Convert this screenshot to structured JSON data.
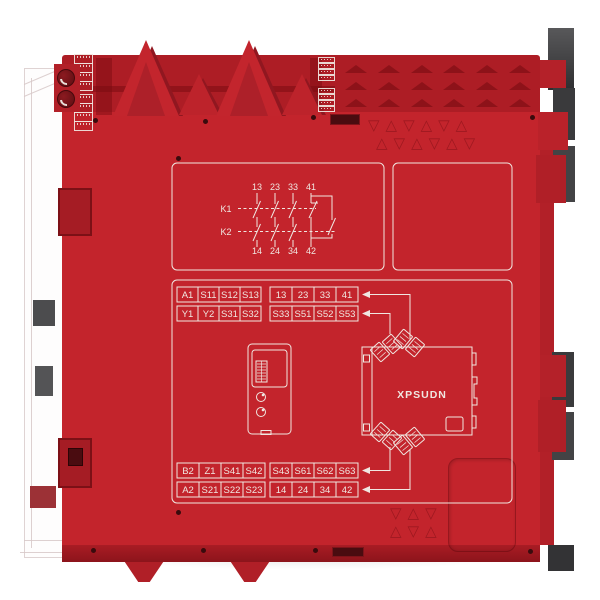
{
  "product": {
    "model_label": "XPSUDN"
  },
  "contact_diagram": {
    "top_terminals": [
      "13",
      "23",
      "33",
      "41"
    ],
    "relays": [
      "K1",
      "K2"
    ],
    "bottom_terminals": [
      "14",
      "24",
      "34",
      "42"
    ]
  },
  "terminal_tables": {
    "top_left": [
      [
        "A1",
        "S11",
        "S12",
        "S13"
      ],
      [
        "Y1",
        "Y2",
        "S31",
        "S32"
      ]
    ],
    "top_right": [
      [
        "13",
        "23",
        "33",
        "41"
      ],
      [
        "S33",
        "S51",
        "S52",
        "S53"
      ]
    ],
    "bottom_left": [
      [
        "B2",
        "Z1",
        "S41",
        "S42"
      ],
      [
        "A2",
        "S21",
        "S22",
        "S23"
      ]
    ],
    "bottom_right": [
      [
        "S43",
        "S61",
        "S62",
        "S63"
      ],
      [
        "14",
        "24",
        "34",
        "42"
      ]
    ]
  },
  "embossed_marks": {
    "top_row1": "▽△▽△▽△",
    "top_row2": "△▽△▽△▽",
    "bottom_row1": "▽△▽",
    "bottom_row2": "△▽△"
  },
  "colors": {
    "body_red": "#c3242c",
    "dark_red": "#8f161d",
    "print_white": "#f0e7e1",
    "clip_gray": "#3a3a3c",
    "background": "#ffffff"
  }
}
